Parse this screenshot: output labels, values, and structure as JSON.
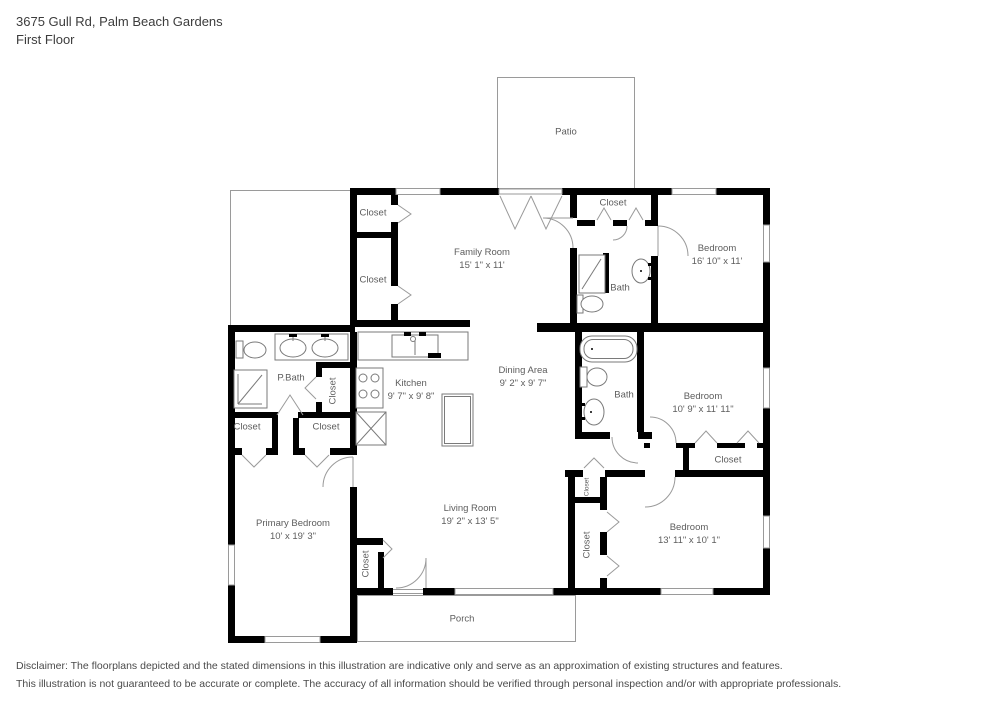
{
  "header": {
    "address": "3675 Gull Rd, Palm Beach Gardens",
    "floor": "First Floor"
  },
  "plan": {
    "closet_label": "Closet",
    "rooms": [
      {
        "id": "patio",
        "name": "Patio",
        "dims": ""
      },
      {
        "id": "family-room",
        "name": "Family Room",
        "dims": "15' 1\" x 11'"
      },
      {
        "id": "bedroom-top-right",
        "name": "Bedroom",
        "dims": "16' 10\" x 11'"
      },
      {
        "id": "bath-top",
        "name": "Bath",
        "dims": ""
      },
      {
        "id": "primary-bath",
        "name": "P.Bath",
        "dims": ""
      },
      {
        "id": "kitchen",
        "name": "Kitchen",
        "dims": "9' 7\" x 9' 8\""
      },
      {
        "id": "dining-area",
        "name": "Dining Area",
        "dims": "9' 2\" x 9' 7\""
      },
      {
        "id": "bath-middle",
        "name": "Bath",
        "dims": ""
      },
      {
        "id": "bedroom-mid-right",
        "name": "Bedroom",
        "dims": "10' 9\" x 11' 11\""
      },
      {
        "id": "primary-bedroom",
        "name": "Primary Bedroom",
        "dims": "10' x 19' 3\""
      },
      {
        "id": "living-room",
        "name": "Living Room",
        "dims": "19' 2\" x 13' 5\""
      },
      {
        "id": "bedroom-bottom-right",
        "name": "Bedroom",
        "dims": "13' 11\" x 10' 1\""
      },
      {
        "id": "porch",
        "name": "Porch",
        "dims": ""
      }
    ]
  },
  "footer": {
    "line1": "Disclaimer: The floorplans depicted and the stated dimensions in this illustration are indicative only and serve as an approximation of existing structures and features.",
    "line2": "This illustration is not guaranteed to be accurate or complete. The accuracy of all information should be verified through personal inspection and/or with appropriate professionals."
  },
  "colors": {
    "wall": "#000000",
    "thin_line": "#9a9a9a",
    "label": "#5d5d5d",
    "background": "#ffffff"
  }
}
